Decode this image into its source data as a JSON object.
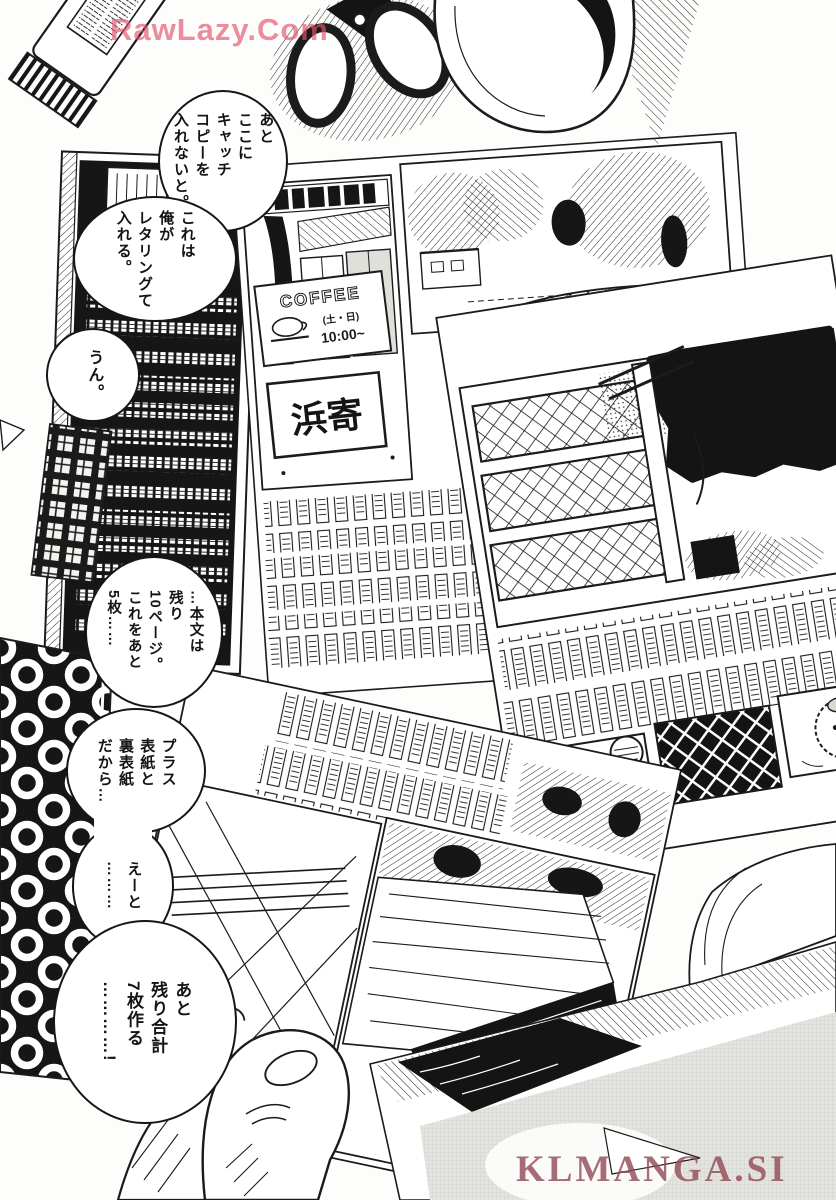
{
  "watermarks": {
    "top": "RawLazy.Com",
    "bottom": "KLMANGA.SI",
    "top_color": "#e4546c",
    "bottom_color": "#934d58"
  },
  "bubbles": {
    "b1": "あと\nここに\nキャッチ\nコピーを\n入れないと。",
    "b2": "これは\n俺が\nレタリングて\n入れる。",
    "b3": "うん。",
    "b4": "…本文は\n残り\n10ページ。\nこれをあと\n5枚……",
    "b5": "プラス\n表紙と\n裏表紙\nだから…",
    "b5b": "えーと\n………",
    "b6": "あと\n残り合計\n7枚作る\n…………!"
  },
  "artwork": {
    "coffee_sign": {
      "line1": "COFFEE",
      "line2": "(土・日)",
      "line3": "10:00~"
    },
    "shop_sign": "浜寄"
  },
  "ink": "#1b1b1b",
  "tone_gray": "#e3e3df"
}
